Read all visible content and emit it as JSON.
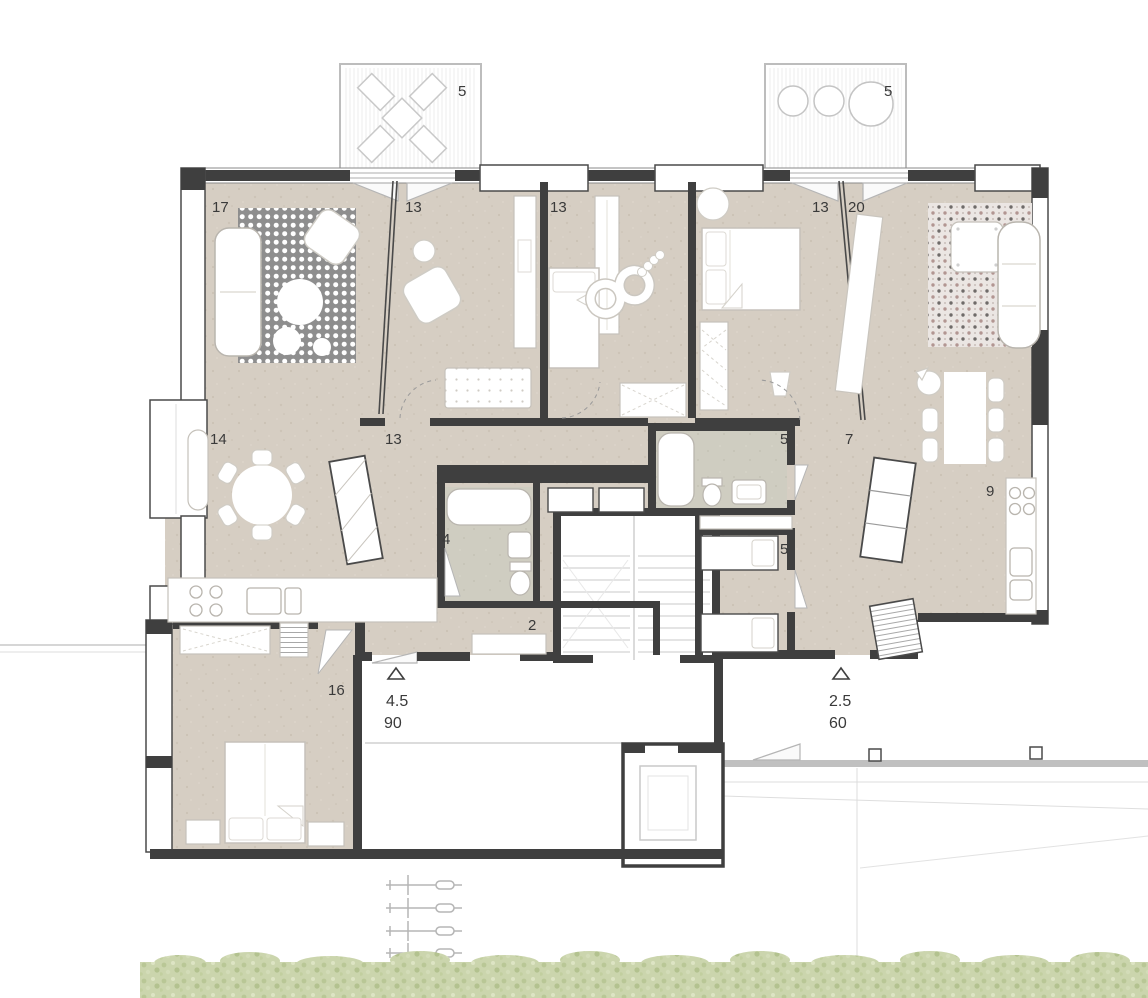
{
  "title": "Apartment floor plan",
  "labels": {
    "balcony_left": "5",
    "balcony_right": "5",
    "living_17": "17",
    "bedroom_13a": "13",
    "bedroom_13b": "13",
    "bedroom_13c": "13",
    "living_20": "20",
    "dining_14": "14",
    "corridor_13": "13",
    "bathroom_4": "4",
    "entry_2": "2",
    "bathroom_5": "5",
    "corridor_7": "7",
    "storage_5": "5",
    "kitchen_9": "9",
    "bedroom_16": "16"
  },
  "entrances": {
    "left": {
      "line1": "4.5",
      "line2": "90"
    },
    "right": {
      "line1": "2.5",
      "line2": "60"
    }
  },
  "colors": {
    "floor": "#d6cec3",
    "wet_floor": "#cfcdc1",
    "wall": "#3f3f3f",
    "rug_dark": "#8e8e8e",
    "rug_mosaic_base": "#ebe6e3",
    "furniture_line": "#b9b5ae",
    "hedge_green": "#cbd5ad"
  }
}
